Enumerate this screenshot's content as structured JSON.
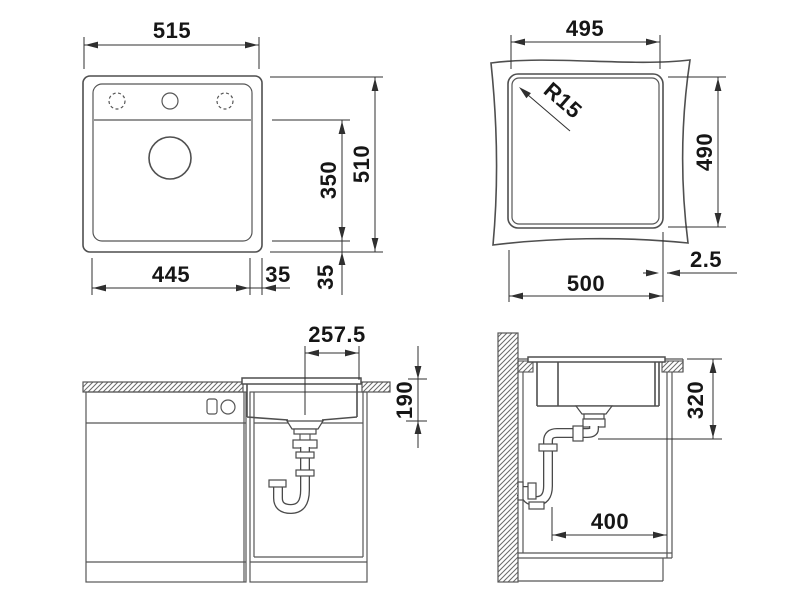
{
  "drawing": {
    "kind": "sink-installation-technical-drawing",
    "top_view": {
      "overall_width": "515",
      "overall_depth": "510",
      "bowl_depth": "350",
      "bowl_width": "445",
      "rim_right": "35",
      "rim_bottom": "35"
    },
    "cutout_view": {
      "cutout_width": "495",
      "cutout_height": "490",
      "corner_radius": "R15",
      "outer_width": "500",
      "reveal_gap": "2.5"
    },
    "front_view": {
      "center_to_edge": "257.5",
      "bowl_inner_depth": "190"
    },
    "side_view": {
      "depth_with_drain": "320",
      "rear_clearance": "400"
    },
    "colors": {
      "line": "#4f4f4f",
      "dimension": "#2f2f2f",
      "text": "#161616",
      "background": "#ffffff"
    }
  }
}
